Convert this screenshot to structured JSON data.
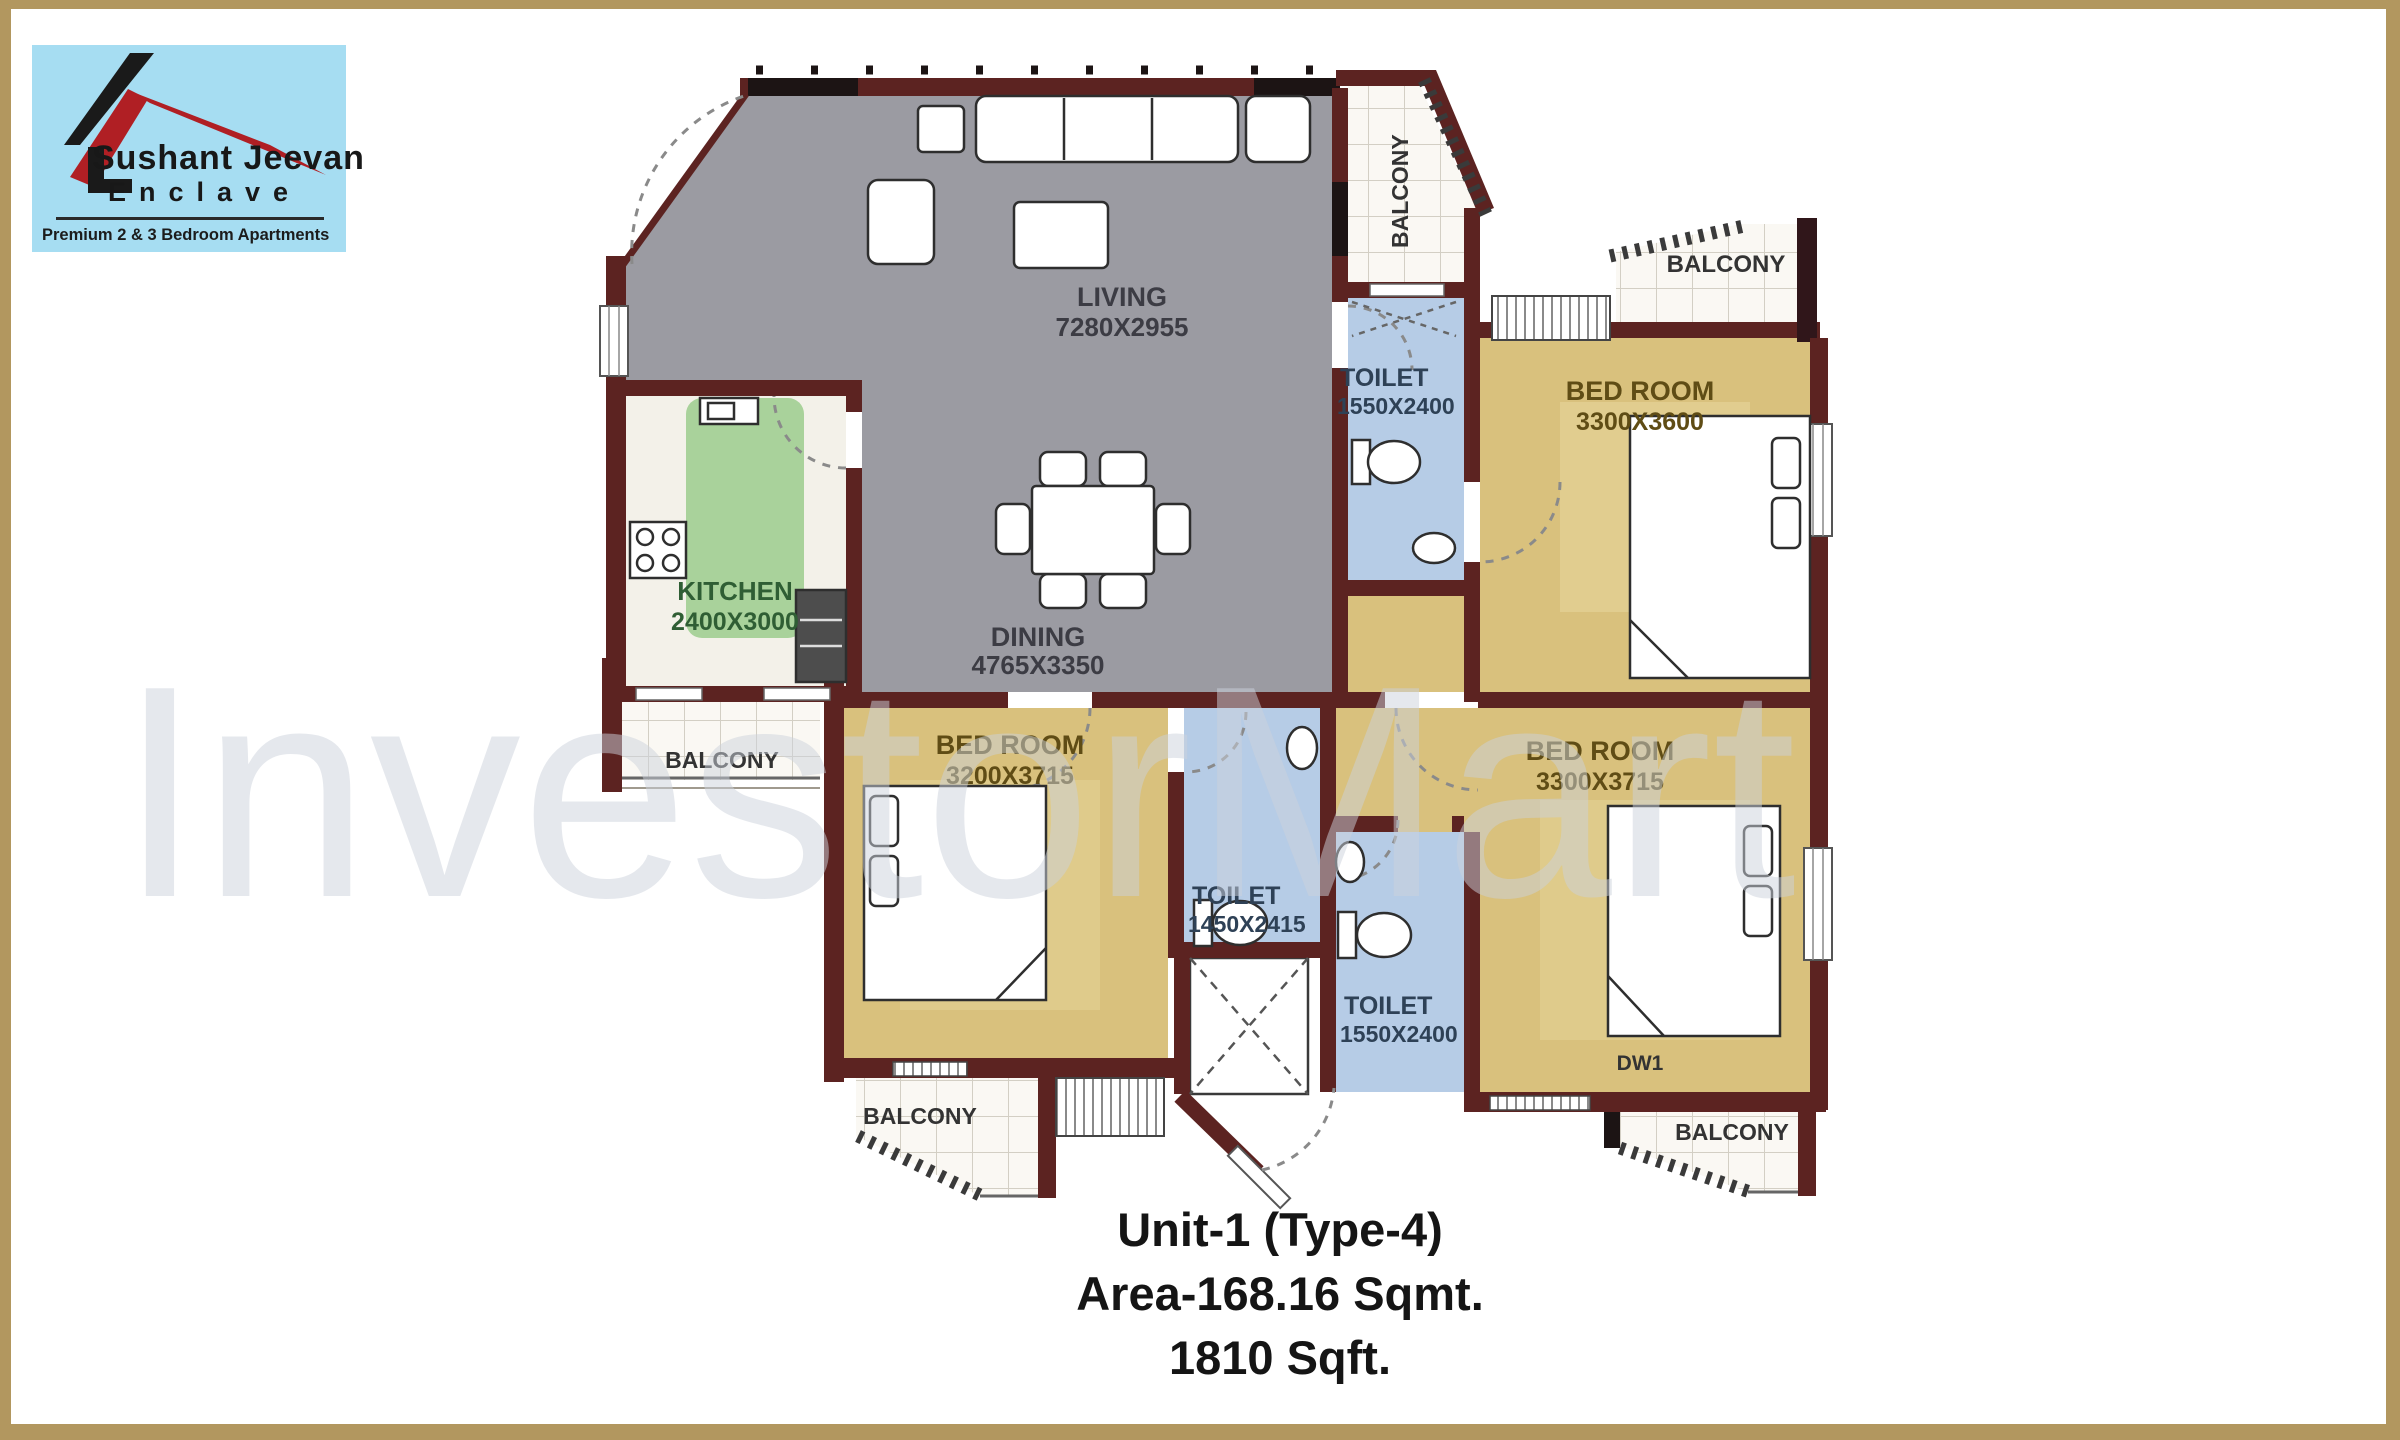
{
  "logo": {
    "title": "Sushant Jeevan",
    "subtitle": "Enclave",
    "tagline": "Premium 2 & 3 Bedroom Apartments",
    "bg_color": "#a6ddf2",
    "roof_red": "#b01f24",
    "roof_black": "#1a1a1a"
  },
  "watermark": {
    "text": "InvestorMart"
  },
  "rooms": {
    "living": {
      "name": "LIVING",
      "dim": "7280X2955"
    },
    "dining": {
      "name": "DINING",
      "dim": "4765X3350"
    },
    "kitchen": {
      "name": "KITCHEN",
      "dim": "2400X3000"
    },
    "toilet_top": {
      "name": "TOILET",
      "dim": "1550X2400"
    },
    "toilet_mid": {
      "name": "TOILET",
      "dim": "1450X2415"
    },
    "toilet_bottom": {
      "name": "TOILET",
      "dim": "1550X2400"
    },
    "bedroom_top_right": {
      "name": "BED ROOM",
      "dim": "3300X3600"
    },
    "bedroom_bottom_left": {
      "name": "BED ROOM",
      "dim": "3200X3715"
    },
    "bedroom_bottom_right": {
      "name": "BED ROOM",
      "dim": "3300X3715"
    }
  },
  "balconies": {
    "top": "BALCONY",
    "top_right": "BALCONY",
    "left": "BALCONY",
    "bottom_left": "BALCONY",
    "bottom_right": "BALCONY"
  },
  "labels": {
    "dw1": "DW1"
  },
  "unit": {
    "line1": "Unit-1 (Type-4)",
    "line2": "Area-168.16 Sqmt.",
    "line3": "1810 Sqft."
  },
  "colors": {
    "border_tan": "#b2975f",
    "wall": "#5c2321",
    "wall_black": "#1c1414",
    "floor_living": "#9b9ba2",
    "floor_bedroom": "#d9c17d",
    "floor_toilet": "#b6cce6",
    "floor_kitchen": "#a9d29b",
    "balcony_tile": "#faf8f3",
    "watermark_gray": "#e9ebee"
  }
}
